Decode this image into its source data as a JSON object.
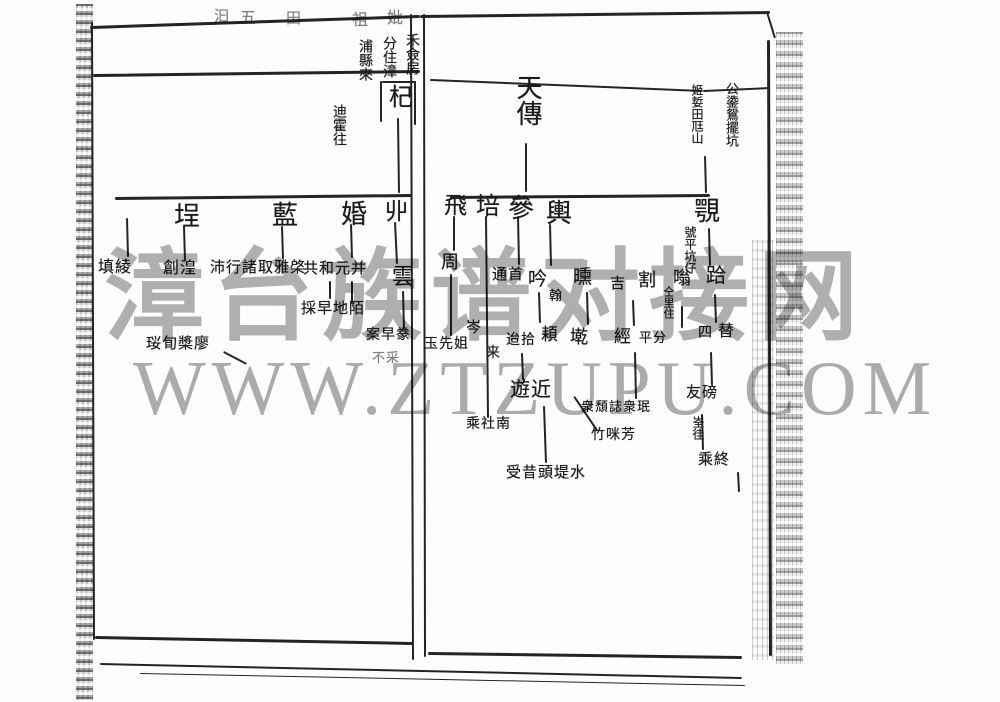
{
  "document_type": "genealogy-scan",
  "watermark": {
    "line1": "漳台族谱对接网",
    "line2": "WWW.ZTZUPU.COM",
    "color": "#b1b1b1"
  },
  "ink_color": "#242424",
  "scan": {
    "borders": [
      {
        "x1": 90,
        "y1": 26,
        "x2": 420,
        "y2": 15,
        "w": 2.5
      },
      {
        "x1": 420,
        "y1": 15,
        "x2": 770,
        "y2": 11,
        "w": 2.5
      },
      {
        "x1": 768,
        "y1": 12,
        "x2": 776,
        "y2": 38,
        "w": 2
      },
      {
        "x1": 93,
        "y1": 74,
        "x2": 420,
        "y2": 70,
        "w": 2.5
      },
      {
        "x1": 430,
        "y1": 79,
        "x2": 703,
        "y2": 90,
        "w": 2
      },
      {
        "x1": 703,
        "y1": 90,
        "x2": 770,
        "y2": 87,
        "w": 2
      },
      {
        "x1": 93,
        "y1": 22,
        "x2": 95,
        "y2": 640,
        "w": 2
      },
      {
        "x1": 412,
        "y1": 14,
        "x2": 414,
        "y2": 660,
        "w": 2
      },
      {
        "x1": 425,
        "y1": 14,
        "x2": 426,
        "y2": 657,
        "w": 2
      },
      {
        "x1": 95,
        "y1": 636,
        "x2": 413,
        "y2": 642,
        "w": 2.5
      },
      {
        "x1": 428,
        "y1": 652,
        "x2": 742,
        "y2": 656,
        "w": 2.5
      },
      {
        "x1": 770,
        "y1": 40,
        "x2": 772,
        "y2": 656,
        "w": 2.5
      },
      {
        "x1": 100,
        "y1": 663,
        "x2": 742,
        "y2": 677,
        "w": 1.5
      },
      {
        "x1": 140,
        "y1": 673,
        "x2": 745,
        "y2": 685,
        "w": 1
      },
      {
        "x1": 382,
        "y1": 81,
        "x2": 416,
        "y2": 81,
        "w": 1.5
      },
      {
        "x1": 416,
        "y1": 81,
        "x2": 416,
        "y2": 125,
        "w": 1.5
      },
      {
        "x1": 382,
        "y1": 81,
        "x2": 382,
        "y2": 122,
        "w": 1.5
      }
    ],
    "lines": [
      {
        "x1": 399,
        "y1": 118,
        "x2": 400,
        "y2": 193,
        "w": 2
      },
      {
        "x1": 115,
        "y1": 197,
        "x2": 412,
        "y2": 194,
        "w": 2.5
      },
      {
        "x1": 128,
        "y1": 218,
        "x2": 129,
        "y2": 257,
        "w": 2
      },
      {
        "x1": 185,
        "y1": 226,
        "x2": 186,
        "y2": 261,
        "w": 2
      },
      {
        "x1": 283,
        "y1": 226,
        "x2": 284,
        "y2": 259,
        "w": 2
      },
      {
        "x1": 352,
        "y1": 224,
        "x2": 353,
        "y2": 258,
        "w": 2
      },
      {
        "x1": 396,
        "y1": 222,
        "x2": 398,
        "y2": 264,
        "w": 2
      },
      {
        "x1": 331,
        "y1": 281,
        "x2": 331,
        "y2": 299,
        "w": 1.5
      },
      {
        "x1": 353,
        "y1": 281,
        "x2": 353,
        "y2": 304,
        "w": 1.5
      },
      {
        "x1": 404,
        "y1": 291,
        "x2": 405,
        "y2": 329,
        "w": 1.5
      },
      {
        "x1": 224,
        "y1": 351,
        "x2": 247,
        "y2": 363,
        "w": 2
      },
      {
        "x1": 527,
        "y1": 143,
        "x2": 527,
        "y2": 192,
        "w": 2
      },
      {
        "x1": 450,
        "y1": 196,
        "x2": 710,
        "y2": 194,
        "w": 2.5
      },
      {
        "x1": 706,
        "y1": 156,
        "x2": 707,
        "y2": 193,
        "w": 1.5
      },
      {
        "x1": 455,
        "y1": 216,
        "x2": 455,
        "y2": 251,
        "w": 2
      },
      {
        "x1": 487,
        "y1": 216,
        "x2": 489,
        "y2": 418,
        "w": 2
      },
      {
        "x1": 519,
        "y1": 216,
        "x2": 520,
        "y2": 265,
        "w": 2
      },
      {
        "x1": 551,
        "y1": 224,
        "x2": 552,
        "y2": 266,
        "w": 2
      },
      {
        "x1": 540,
        "y1": 292,
        "x2": 541,
        "y2": 323,
        "w": 1.5
      },
      {
        "x1": 588,
        "y1": 292,
        "x2": 589,
        "y2": 325,
        "w": 1.5
      },
      {
        "x1": 452,
        "y1": 274,
        "x2": 452,
        "y2": 336,
        "w": 1.5
      },
      {
        "x1": 523,
        "y1": 353,
        "x2": 524,
        "y2": 380,
        "w": 1.5
      },
      {
        "x1": 545,
        "y1": 406,
        "x2": 547,
        "y2": 463,
        "w": 1.5
      },
      {
        "x1": 575,
        "y1": 396,
        "x2": 598,
        "y2": 430,
        "w": 1.5
      },
      {
        "x1": 634,
        "y1": 300,
        "x2": 635,
        "y2": 326,
        "w": 1.5
      },
      {
        "x1": 636,
        "y1": 352,
        "x2": 637,
        "y2": 399,
        "w": 1.5
      },
      {
        "x1": 683,
        "y1": 306,
        "x2": 683,
        "y2": 328,
        "w": 1.5
      },
      {
        "x1": 716,
        "y1": 294,
        "x2": 717,
        "y2": 323,
        "w": 1.5
      },
      {
        "x1": 712,
        "y1": 352,
        "x2": 713,
        "y2": 385,
        "w": 1.5
      },
      {
        "x1": 703,
        "y1": 414,
        "x2": 704,
        "y2": 450,
        "w": 1.5
      },
      {
        "x1": 739,
        "y1": 472,
        "x2": 740,
        "y2": 492,
        "w": 1.5
      },
      {
        "x1": 710,
        "y1": 228,
        "x2": 711,
        "y2": 266,
        "w": 1.5
      }
    ],
    "nodes": [
      {
        "t": "汩",
        "x": 214,
        "y": 10,
        "s": 15,
        "faint": true
      },
      {
        "t": "五",
        "x": 240,
        "y": 11,
        "s": 16,
        "faint": true
      },
      {
        "t": "田",
        "x": 286,
        "y": 12,
        "s": 15,
        "faint": true
      },
      {
        "t": "祖",
        "x": 352,
        "y": 13,
        "s": 16,
        "faint": true
      },
      {
        "t": "妣",
        "x": 387,
        "y": 11,
        "s": 16,
        "faint": true
      },
      {
        "t": "禾僉房",
        "x": 404,
        "y": 33,
        "s": 14,
        "v": true
      },
      {
        "t": "分住漳",
        "x": 381,
        "y": 36,
        "s": 14,
        "v": true
      },
      {
        "t": "浦縣來",
        "x": 357,
        "y": 39,
        "s": 14,
        "v": true
      },
      {
        "t": "迪霍往",
        "x": 331,
        "y": 104,
        "s": 14,
        "v": true
      },
      {
        "t": "杞",
        "x": 389,
        "y": 86,
        "s": 24
      },
      {
        "t": "埕",
        "x": 174,
        "y": 203,
        "s": 26
      },
      {
        "t": "藍",
        "x": 272,
        "y": 202,
        "s": 26
      },
      {
        "t": "婚",
        "x": 341,
        "y": 201,
        "s": 26
      },
      {
        "t": "丱",
        "x": 385,
        "y": 200,
        "s": 23
      },
      {
        "t": "填綾",
        "x": 98,
        "y": 260,
        "s": 16
      },
      {
        "t": "創湟",
        "x": 163,
        "y": 261,
        "s": 16
      },
      {
        "t": "沛行諸取雅棨",
        "x": 210,
        "y": 261,
        "s": 15
      },
      {
        "t": "共和元并",
        "x": 303,
        "y": 262,
        "s": 15
      },
      {
        "t": "雲",
        "x": 392,
        "y": 265,
        "s": 22
      },
      {
        "t": "採早地陌",
        "x": 301,
        "y": 302,
        "s": 15
      },
      {
        "t": "珱䀏槳廖",
        "x": 146,
        "y": 337,
        "s": 15
      },
      {
        "t": "案早豢",
        "x": 366,
        "y": 329,
        "s": 14
      },
      {
        "t": "不采",
        "x": 372,
        "y": 351,
        "s": 13,
        "faint": true
      },
      {
        "t": "天傳",
        "x": 514,
        "y": 74,
        "s": 26,
        "v": true
      },
      {
        "t": "姬娎田尫山",
        "x": 691,
        "y": 84,
        "s": 12,
        "v": true
      },
      {
        "t": "公鍌鴛擺坑",
        "x": 725,
        "y": 82,
        "s": 13,
        "v": true
      },
      {
        "t": "飛",
        "x": 444,
        "y": 194,
        "s": 23
      },
      {
        "t": "培",
        "x": 476,
        "y": 195,
        "s": 24
      },
      {
        "t": "參",
        "x": 508,
        "y": 195,
        "s": 26
      },
      {
        "t": "輿",
        "x": 546,
        "y": 200,
        "s": 26
      },
      {
        "t": "覨",
        "x": 694,
        "y": 198,
        "s": 26
      },
      {
        "t": "號平坑仔",
        "x": 684,
        "y": 226,
        "s": 12,
        "v": true
      },
      {
        "t": "周",
        "x": 441,
        "y": 253,
        "s": 18
      },
      {
        "t": "通首",
        "x": 492,
        "y": 268,
        "s": 15
      },
      {
        "t": "吟",
        "x": 528,
        "y": 270,
        "s": 19
      },
      {
        "t": "翰",
        "x": 549,
        "y": 289,
        "s": 13
      },
      {
        "t": "曛",
        "x": 573,
        "y": 268,
        "s": 19
      },
      {
        "t": "吉",
        "x": 610,
        "y": 277,
        "s": 15
      },
      {
        "t": "割",
        "x": 638,
        "y": 271,
        "s": 18
      },
      {
        "t": "嗡",
        "x": 673,
        "y": 269,
        "s": 18
      },
      {
        "t": "仝里住",
        "x": 662,
        "y": 286,
        "s": 11,
        "v": true
      },
      {
        "t": "跲",
        "x": 706,
        "y": 266,
        "s": 20
      },
      {
        "t": "玉先姐",
        "x": 424,
        "y": 338,
        "s": 14
      },
      {
        "t": "岑",
        "x": 466,
        "y": 321,
        "s": 15
      },
      {
        "t": "来",
        "x": 486,
        "y": 347,
        "s": 14
      },
      {
        "t": "迨拾",
        "x": 506,
        "y": 334,
        "s": 14
      },
      {
        "t": "頛",
        "x": 541,
        "y": 326,
        "s": 17
      },
      {
        "t": "墘",
        "x": 570,
        "y": 328,
        "s": 18
      },
      {
        "t": "經",
        "x": 614,
        "y": 328,
        "s": 17
      },
      {
        "t": "平分",
        "x": 639,
        "y": 331,
        "s": 13
      },
      {
        "t": "四",
        "x": 698,
        "y": 327,
        "s": 14
      },
      {
        "t": "替",
        "x": 718,
        "y": 324,
        "s": 16
      },
      {
        "t": "遊近",
        "x": 510,
        "y": 380,
        "s": 20
      },
      {
        "t": "乘社南",
        "x": 466,
        "y": 418,
        "s": 14
      },
      {
        "t": "衆頹誌衆珉",
        "x": 581,
        "y": 400,
        "s": 13
      },
      {
        "t": "竹咪芳",
        "x": 591,
        "y": 429,
        "s": 14
      },
      {
        "t": "受昔頭堤水",
        "x": 506,
        "y": 466,
        "s": 15
      },
      {
        "t": "友磅",
        "x": 686,
        "y": 386,
        "s": 15
      },
      {
        "t": "峑徍",
        "x": 692,
        "y": 416,
        "s": 12,
        "v": true
      },
      {
        "t": "乘終",
        "x": 698,
        "y": 453,
        "s": 15
      }
    ]
  }
}
